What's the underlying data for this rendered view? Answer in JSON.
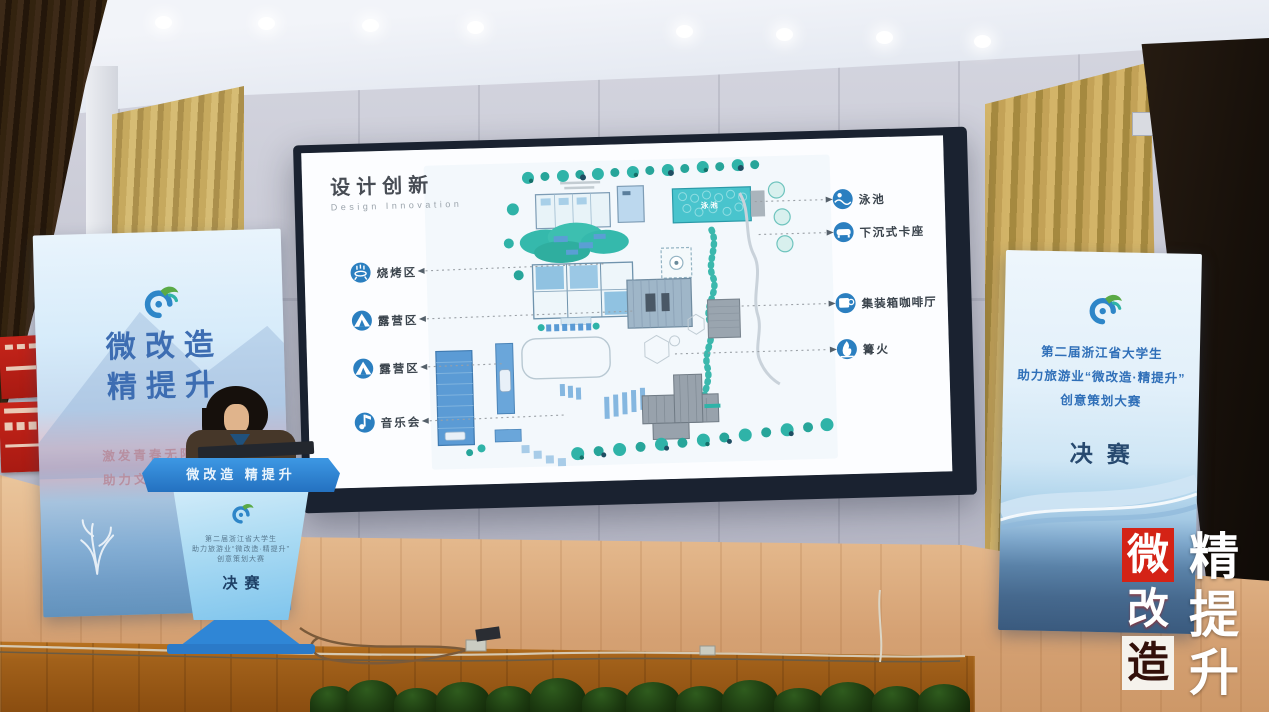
{
  "screen": {
    "title": "设计创新",
    "subtitle": "Design Innovation",
    "plan": {
      "pool_label": "泳池"
    },
    "legend_left": [
      {
        "label": "烧烤区",
        "icon": "grill-icon"
      },
      {
        "label": "露营区",
        "icon": "tent-icon"
      },
      {
        "label": "露营区",
        "icon": "tent-icon"
      },
      {
        "label": "音乐会",
        "icon": "music-icon"
      }
    ],
    "legend_right": [
      {
        "label": "泳池",
        "icon": "swimmer-icon"
      },
      {
        "label": "下沉式卡座",
        "icon": "sofa-icon"
      },
      {
        "label": "集装箱咖啡厅",
        "icon": "coffee-icon"
      },
      {
        "label": "篝火",
        "icon": "bonfire-icon"
      }
    ]
  },
  "left_banner": {
    "title_line1": "微改造",
    "title_line2": "精提升",
    "slogan_line1": "激发青春无限创意",
    "slogan_line2": "助力文旅深度融合"
  },
  "right_banner": {
    "line1": "第二届浙江省大学生",
    "line2": "助力旅游业“微改造·精提升”",
    "line3": "创意策划大赛",
    "final_label": "决赛"
  },
  "podium": {
    "header": "微改造 精提升",
    "line1": "第二届浙江省大学生",
    "line2": "助力旅游业“微改造·精提升”",
    "line3": "创意策划大赛",
    "final_label": "决赛"
  },
  "watermark": {
    "col_left": [
      "微",
      "改",
      "造"
    ],
    "col_right": [
      "精",
      "提",
      "升"
    ]
  },
  "colors": {
    "accent_blue": "#2b7fc0",
    "teal": "#2fb3a8",
    "seal_red": "#d42316",
    "podium_blue": "#2f86d6"
  }
}
